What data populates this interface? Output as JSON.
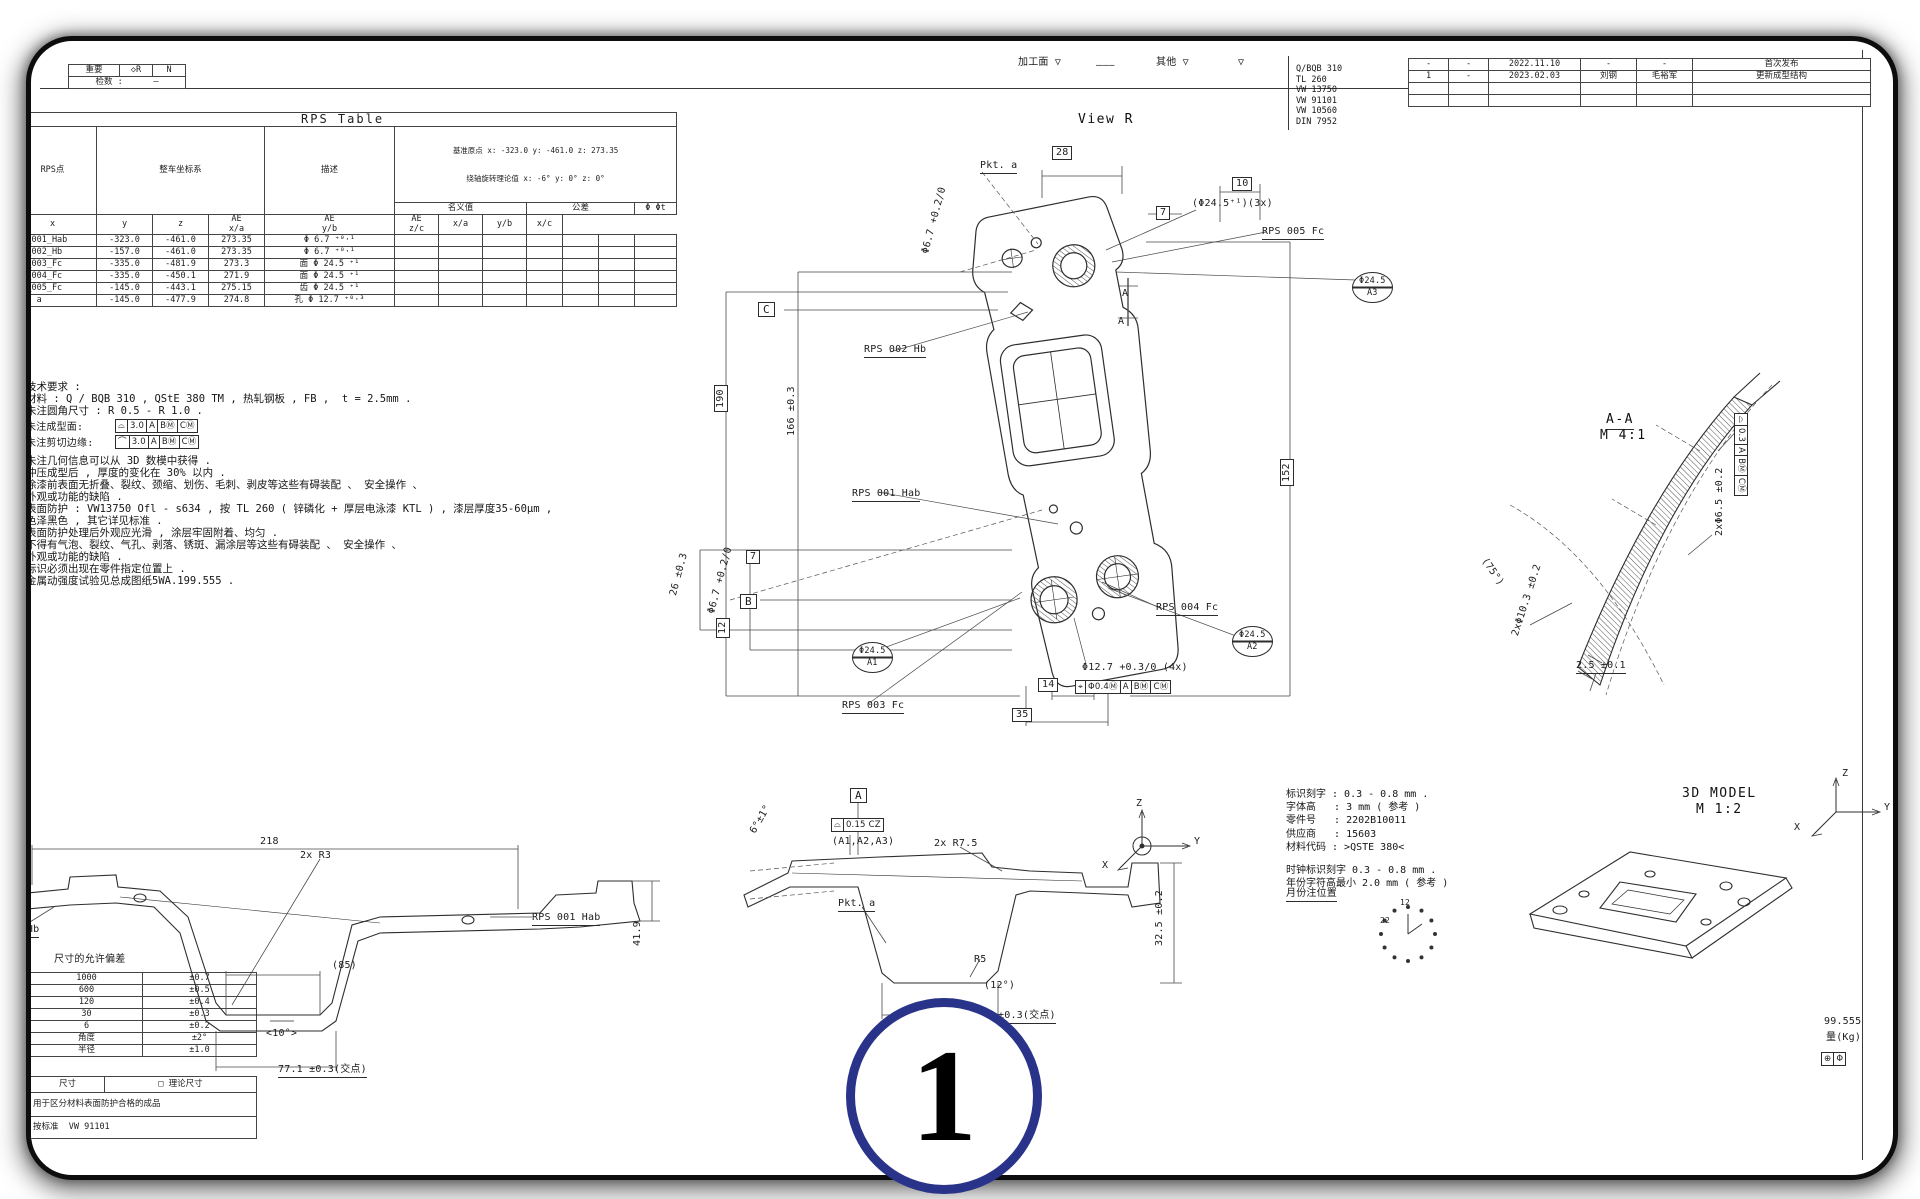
{
  "page": {
    "big_marker": "1"
  },
  "top_left_box": {
    "c1": "重要",
    "c2": "◇R",
    "c3": "N",
    "c4": "检数 :      —"
  },
  "rps_table": {
    "title": "RPS Table",
    "h_point": "RPS点",
    "h_coord": "整车坐标系",
    "h_desc": "描述",
    "h_origin": "基准原点 x: -323.0 y: -461.0 z: 273.35",
    "h_rot": "绕轴旋转理论值 x: -6° y: 0° z: 0°",
    "h_nominal": "名义值",
    "h_tol": "公差",
    "h_phi": "Φ Φt",
    "sub_rows": [
      [
        "x",
        "y",
        "z",
        "AE\nx/a",
        "AE\ny/b",
        "AE\nz/c",
        "x/a",
        "y/b",
        "x/c"
      ]
    ],
    "rows": [
      [
        "RPS_001_Hab",
        "-323.0",
        "-461.0",
        "273.35",
        "Φ 6.7 ⁺⁰·¹",
        "",
        "",
        "",
        "",
        "",
        "",
        ""
      ],
      [
        "RPS_002_Hb",
        "-157.0",
        "-461.0",
        "273.35",
        "Φ 6.7 ⁺⁰·¹",
        "",
        "",
        "",
        "",
        "",
        "",
        ""
      ],
      [
        "RPS_003_Fc",
        "-335.0",
        "-481.9",
        "273.3",
        "面 Φ 24.5 ⁺¹",
        "",
        "",
        "",
        "",
        "",
        "",
        ""
      ],
      [
        "RPS_004_Fc",
        "-335.0",
        "-450.1",
        "271.9",
        "面 Φ 24.5 ⁺¹",
        "",
        "",
        "",
        "",
        "",
        "",
        ""
      ],
      [
        "RPS_005_Fc",
        "-145.0",
        "-443.1",
        "275.15",
        "齿 Φ 24.5 ⁺¹",
        "",
        "",
        "",
        "",
        "",
        "",
        ""
      ],
      [
        "Pkt. a",
        "-145.0",
        "-477.9",
        "274.8",
        "孔 Φ 12.7 ⁺⁰·³",
        "",
        "",
        "",
        "",
        "",
        "",
        ""
      ]
    ]
  },
  "standards": [
    "Q/BQB 310",
    "TL 260",
    "VW 13750",
    "VW 91101",
    "VW 10560",
    "DIN 7952"
  ],
  "revisions": {
    "rows": [
      [
        "-",
        "-",
        "2022.11.10",
        "-",
        "-",
        "首次发布"
      ],
      [
        "1",
        "-",
        "2023.02.03",
        "刘钢",
        "毛裕军",
        "更新成型结构"
      ],
      [
        "",
        "",
        "",
        "",
        "",
        ""
      ],
      [
        "",
        "",
        "",
        "",
        "",
        ""
      ]
    ]
  },
  "notes": {
    "lines1": [
      "技术要求 :",
      "材料 : Q / BQB 310 , QStE 380 TM , 热轧钢板 , FB ,  t = 2.5mm .",
      "未注圆角尺寸 : R 0.5 - R 1.0 ."
    ],
    "lines2": [
      "未注几何信息可以从 3D 数模中获得 .",
      "冲压成型后 , 厚度的变化在 30% 以内 .",
      "涂漆前表面无折叠、裂纹、颈缩、划伤、毛刺、剥皮等这些有碍装配 、 安全操作 、",
      "外观或功能的缺陷 .",
      "表面防护 : VW13750 Ofl - s634 , 按 TL 260 ( 锌磷化 + 厚层电泳漆 KTL ) , 漆层厚度35-60μm ,",
      "色泽黑色 , 其它详见标准 .",
      "表面防护处理后外观应光滑 , 涂层牢固附着、均匀 .",
      "不得有气泡、裂纹、气孔、剥落、锈斑、漏涂层等这些有碍装配 、 安全操作 、",
      "外观或功能的缺陷 .",
      "标识必须出现在零件指定位置上 .",
      "金属动强度试验见总成图纸5WA.199.555 ."
    ]
  },
  "marking_notes": {
    "lines": [
      "标识刻字 : 0.3 - 0.8 mm .",
      "字体高   : 3 mm ( 参考 )",
      "零件号   : 2202B10011",
      "供应商   : 15603",
      "材料代码 : >QSTE 380<",
      "",
      "时钟标识刻字 0.3 - 0.8 mm .",
      "年份字符高最小 2.0 mm ( 参考 )"
    ]
  },
  "tolerance_block": {
    "title": "尺寸的允许偏差",
    "rows": [
      [
        "1000",
        "±0.7"
      ],
      [
        "600",
        "±0.5"
      ],
      [
        "120",
        "±0.4"
      ],
      [
        "30",
        "±0.3"
      ],
      [
        "6",
        "±0.2"
      ],
      [
        "角度",
        "±2°"
      ],
      [
        "半径",
        "±1.0"
      ]
    ],
    "note_row_left": "尺寸",
    "note_row_right": "□ 理论尺寸",
    "note1": "用于区分材料表面防护合格的成品",
    "note2": "按标准  VW 91101"
  },
  "colors": {
    "accent": "#283389",
    "line": "#333333"
  },
  "annotations": [
    {
      "n": "mark-stamped-face",
      "t": "加工面 ▽",
      "x": 1018,
      "y": 57
    },
    {
      "n": "mark-dash",
      "t": "———",
      "x": 1096,
      "y": 60
    },
    {
      "n": "mark-other",
      "t": "其他 ▽",
      "x": 1156,
      "y": 57
    },
    {
      "n": "mark-other-triangle",
      "t": "▽",
      "x": 1238,
      "y": 57
    },
    {
      "n": "view-r-title",
      "t": "View R",
      "x": 1078,
      "y": 112,
      "c": "vtitle"
    },
    {
      "n": "dim-28",
      "t": "28",
      "x": 1052,
      "y": 146,
      "c": "boxed"
    },
    {
      "n": "dim-10",
      "t": "10",
      "x": 1232,
      "y": 177,
      "c": "boxed"
    },
    {
      "n": "dim-7-top",
      "t": "7",
      "x": 1156,
      "y": 206,
      "c": "boxed"
    },
    {
      "n": "dim-dia6-7-top",
      "t": "Φ6.7 +0.2/0",
      "x": 920,
      "y": 252,
      "r": -75
    },
    {
      "n": "label-pkt-a",
      "t": "Pkt. a",
      "x": 980,
      "y": 160,
      "c": "underlined"
    },
    {
      "n": "label-dia24-5-3x",
      "t": "(Φ24.5⁺¹)(3x)",
      "x": 1192,
      "y": 198
    },
    {
      "n": "label-rps-005",
      "t": "RPS 005 Fc",
      "x": 1262,
      "y": 226,
      "c": "underlined"
    },
    {
      "n": "balloon-a3",
      "t": "Φ24.5\nA3",
      "x": 1352,
      "y": 272,
      "c": "balloon"
    },
    {
      "n": "section-a-top",
      "t": "A",
      "x": 1122,
      "y": 288
    },
    {
      "n": "section-a-bot",
      "t": "A",
      "x": 1118,
      "y": 316
    },
    {
      "n": "datum-c",
      "t": "C",
      "x": 758,
      "y": 302,
      "c": "boxed datum"
    },
    {
      "n": "label-rps-002",
      "t": "RPS 002 Hb",
      "x": 864,
      "y": 344,
      "c": "underlined"
    },
    {
      "n": "dim-190",
      "t": "190",
      "x": 714,
      "y": 412,
      "r": -90,
      "c": "boxed"
    },
    {
      "n": "dim-166",
      "t": "166 ±0.3",
      "x": 786,
      "y": 436,
      "r": -90
    },
    {
      "n": "dim-152",
      "t": "152",
      "x": 1280,
      "y": 486,
      "r": -90,
      "c": "boxed"
    },
    {
      "n": "label-rps-001",
      "t": "RPS 001 Hab",
      "x": 852,
      "y": 488,
      "c": "underlined"
    },
    {
      "n": "dim-26",
      "t": "26 ±0.3",
      "x": 668,
      "y": 594,
      "r": -75
    },
    {
      "n": "dim-dia6-7-mid",
      "t": "Φ6.7 +0.2/0",
      "x": 706,
      "y": 612,
      "r": -75
    },
    {
      "n": "dim-7-mid",
      "t": "7",
      "x": 746,
      "y": 550,
      "c": "boxed"
    },
    {
      "n": "datum-b",
      "t": "B",
      "x": 740,
      "y": 594,
      "c": "boxed datum"
    },
    {
      "n": "dim-12",
      "t": "12",
      "x": 716,
      "y": 638,
      "r": -90,
      "c": "boxed"
    },
    {
      "n": "label-rps-004",
      "t": "RPS 004 Fc",
      "x": 1156,
      "y": 602,
      "c": "underlined"
    },
    {
      "n": "balloon-a2",
      "t": "Φ24.5\nA2",
      "x": 1232,
      "y": 626,
      "c": "balloon"
    },
    {
      "n": "balloon-a1",
      "t": "Φ24.5\nA1",
      "x": 852,
      "y": 642,
      "c": "balloon"
    },
    {
      "n": "label-rps-003",
      "t": "RPS 003 Fc",
      "x": 842,
      "y": 700,
      "c": "underlined"
    },
    {
      "n": "dim-14",
      "t": "14",
      "x": 1038,
      "y": 678,
      "c": "boxed"
    },
    {
      "n": "dim-35",
      "t": "35",
      "x": 1012,
      "y": 708,
      "c": "boxed"
    },
    {
      "n": "dim-dia12-7",
      "t": "Φ12.7 +0.3/0 (4x)",
      "x": 1082,
      "y": 662
    },
    {
      "n": "fcf-position",
      "t": "⌖|Φ0.4Ⓜ|A|BⓂ|CⓂ",
      "x": 1076,
      "y": 680,
      "c": "fcf"
    },
    {
      "n": "section-aa-title",
      "t": "A-A",
      "x": 1606,
      "y": 412,
      "c": "vtitle underlined"
    },
    {
      "n": "section-aa-scale",
      "t": "M 4:1",
      "x": 1600,
      "y": 428,
      "c": "vtitle"
    },
    {
      "n": "fcf-aa",
      "t": "⌓|0.3|A|BⓂ|CⓂ",
      "x": 1748,
      "y": 414,
      "r": 90,
      "c": "fcf"
    },
    {
      "n": "dim-2x-dia6-5",
      "t": "2xΦ6.5 ±0.2",
      "x": 1714,
      "y": 536,
      "r": -90
    },
    {
      "n": "dim-75deg",
      "t": "(75°)",
      "x": 1488,
      "y": 556,
      "r": 55
    },
    {
      "n": "dim-2x-dia10-3",
      "t": "2xΦ10.3 ±0.2",
      "x": 1510,
      "y": 634,
      "r": -72
    },
    {
      "n": "dim-2-5",
      "t": "2.5 ±0.1",
      "x": 1576,
      "y": 660,
      "c": "underlined"
    },
    {
      "n": "dim-218",
      "t": "218",
      "x": 260,
      "y": 836
    },
    {
      "n": "dim-2x-r3",
      "t": "2x R3",
      "x": 300,
      "y": 850
    },
    {
      "n": "label-rps-001-bl",
      "t": "RPS 001 Hab",
      "x": 532,
      "y": 912,
      "c": "underlined"
    },
    {
      "n": "dim-41-9",
      "t": "41.9",
      "x": 632,
      "y": 946,
      "r": -90
    },
    {
      "n": "label-002-hb",
      "t": "002 Hb",
      "x": 2,
      "y": 924,
      "c": "underlined"
    },
    {
      "n": "dim-85",
      "t": "(85)",
      "x": 332,
      "y": 960
    },
    {
      "n": "dim-10deg",
      "t": "<10°>",
      "x": 266,
      "y": 1028
    },
    {
      "n": "dim-77-1",
      "t": "77.1 ±0.3(交点)",
      "x": 278,
      "y": 1064,
      "c": "underlined"
    },
    {
      "n": "datum-a",
      "t": "A",
      "x": 850,
      "y": 788,
      "c": "boxed datum"
    },
    {
      "n": "fcf-profile",
      "t": "⌓|0.15 CZ",
      "x": 832,
      "y": 818,
      "c": "fcf"
    },
    {
      "n": "label-fcf-datums",
      "t": "(A1,A2,A3)",
      "x": 832,
      "y": 836
    },
    {
      "n": "dim-6deg",
      "t": "6°±1°",
      "x": 748,
      "y": 830,
      "r": -60
    },
    {
      "n": "dim-2x-r7-5",
      "t": "2x R7.5",
      "x": 934,
      "y": 838
    },
    {
      "n": "label-pkt-a-2",
      "t": "Pkt. a",
      "x": 838,
      "y": 898,
      "c": "underlined"
    },
    {
      "n": "dim-r5",
      "t": "R5",
      "x": 974,
      "y": 954
    },
    {
      "n": "dim-12deg",
      "t": "(12°)",
      "x": 984,
      "y": 980
    },
    {
      "n": "dim-32-5",
      "t": "32.5 ±0.2",
      "x": 1154,
      "y": 946,
      "r": -90
    },
    {
      "n": "dim-jiaodian",
      "t": "±0.3(交点)",
      "x": 998,
      "y": 1010,
      "c": "underlined"
    },
    {
      "n": "axis-z",
      "t": "Z",
      "x": 1136,
      "y": 798
    },
    {
      "n": "axis-y",
      "t": "Y",
      "x": 1194,
      "y": 836
    },
    {
      "n": "axis-x",
      "t": "X",
      "x": 1102,
      "y": 860
    },
    {
      "n": "title-3d-model",
      "t": "3D MODEL",
      "x": 1682,
      "y": 786,
      "c": "vtitle"
    },
    {
      "n": "scale-3d-model",
      "t": "M 1:2",
      "x": 1696,
      "y": 802,
      "c": "vtitle"
    },
    {
      "n": "axis-z-3d",
      "t": "Z",
      "x": 1842,
      "y": 768
    },
    {
      "n": "axis-y-3d",
      "t": "Y",
      "x": 1884,
      "y": 802
    },
    {
      "n": "axis-x-3d",
      "t": "X",
      "x": 1794,
      "y": 822
    },
    {
      "n": "label-month-position",
      "t": "月份注位置",
      "x": 1286,
      "y": 888,
      "c": "underlined"
    },
    {
      "n": "clock-12",
      "t": "12",
      "x": 1400,
      "y": 898,
      "c": "tiny"
    },
    {
      "n": "clock-22",
      "t": "22",
      "x": 1380,
      "y": 916,
      "c": "tiny"
    },
    {
      "n": "tol-table-title",
      "t": "尺寸的允许偏差",
      "x": 54,
      "y": 954
    },
    {
      "n": "weight-value",
      "t": "99.555",
      "x": 1824,
      "y": 1016
    },
    {
      "n": "weight-label",
      "t": "量(Kg)",
      "x": 1826,
      "y": 1032
    },
    {
      "n": "corner-symbols",
      "t": "⊕|Φ",
      "x": 1822,
      "y": 1052,
      "c": "fcf"
    }
  ]
}
